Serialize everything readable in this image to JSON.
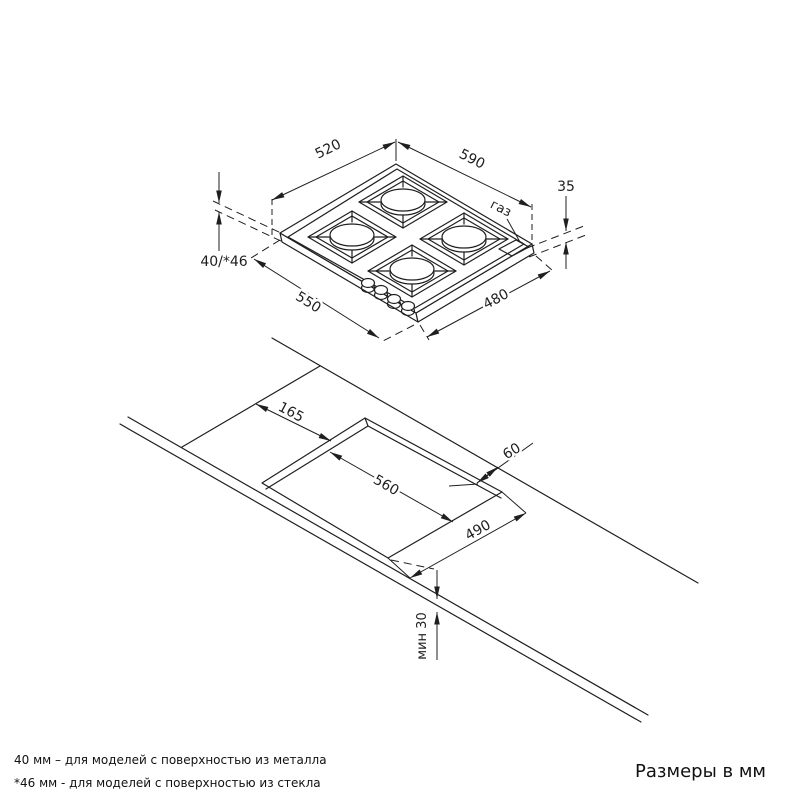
{
  "drawing": {
    "title_hidden": "",
    "colors": {
      "line": "#1f1f1f",
      "background": "#ffffff"
    },
    "top_view": {
      "description": "isometric view of 4-burner gas hob",
      "dims": {
        "width_top": "520",
        "depth_top": "590",
        "gas_height": "35",
        "gas": "газ",
        "body_height": "40/*46",
        "width_bottom": "550",
        "depth_bottom": "480"
      }
    },
    "bottom_view": {
      "description": "countertop cutout isometric view",
      "dims": {
        "side_offset": "165",
        "cutout_length": "560",
        "back_clearance": "60",
        "cutout_width": "490",
        "min_thickness": "мин 30"
      }
    },
    "footer": {
      "note_metal": "40 мм – для моделей с поверхностью  из металла",
      "note_glass": "*46 мм - для моделей с поверхностью  из стекла",
      "units_note": "Размеры в мм"
    }
  }
}
